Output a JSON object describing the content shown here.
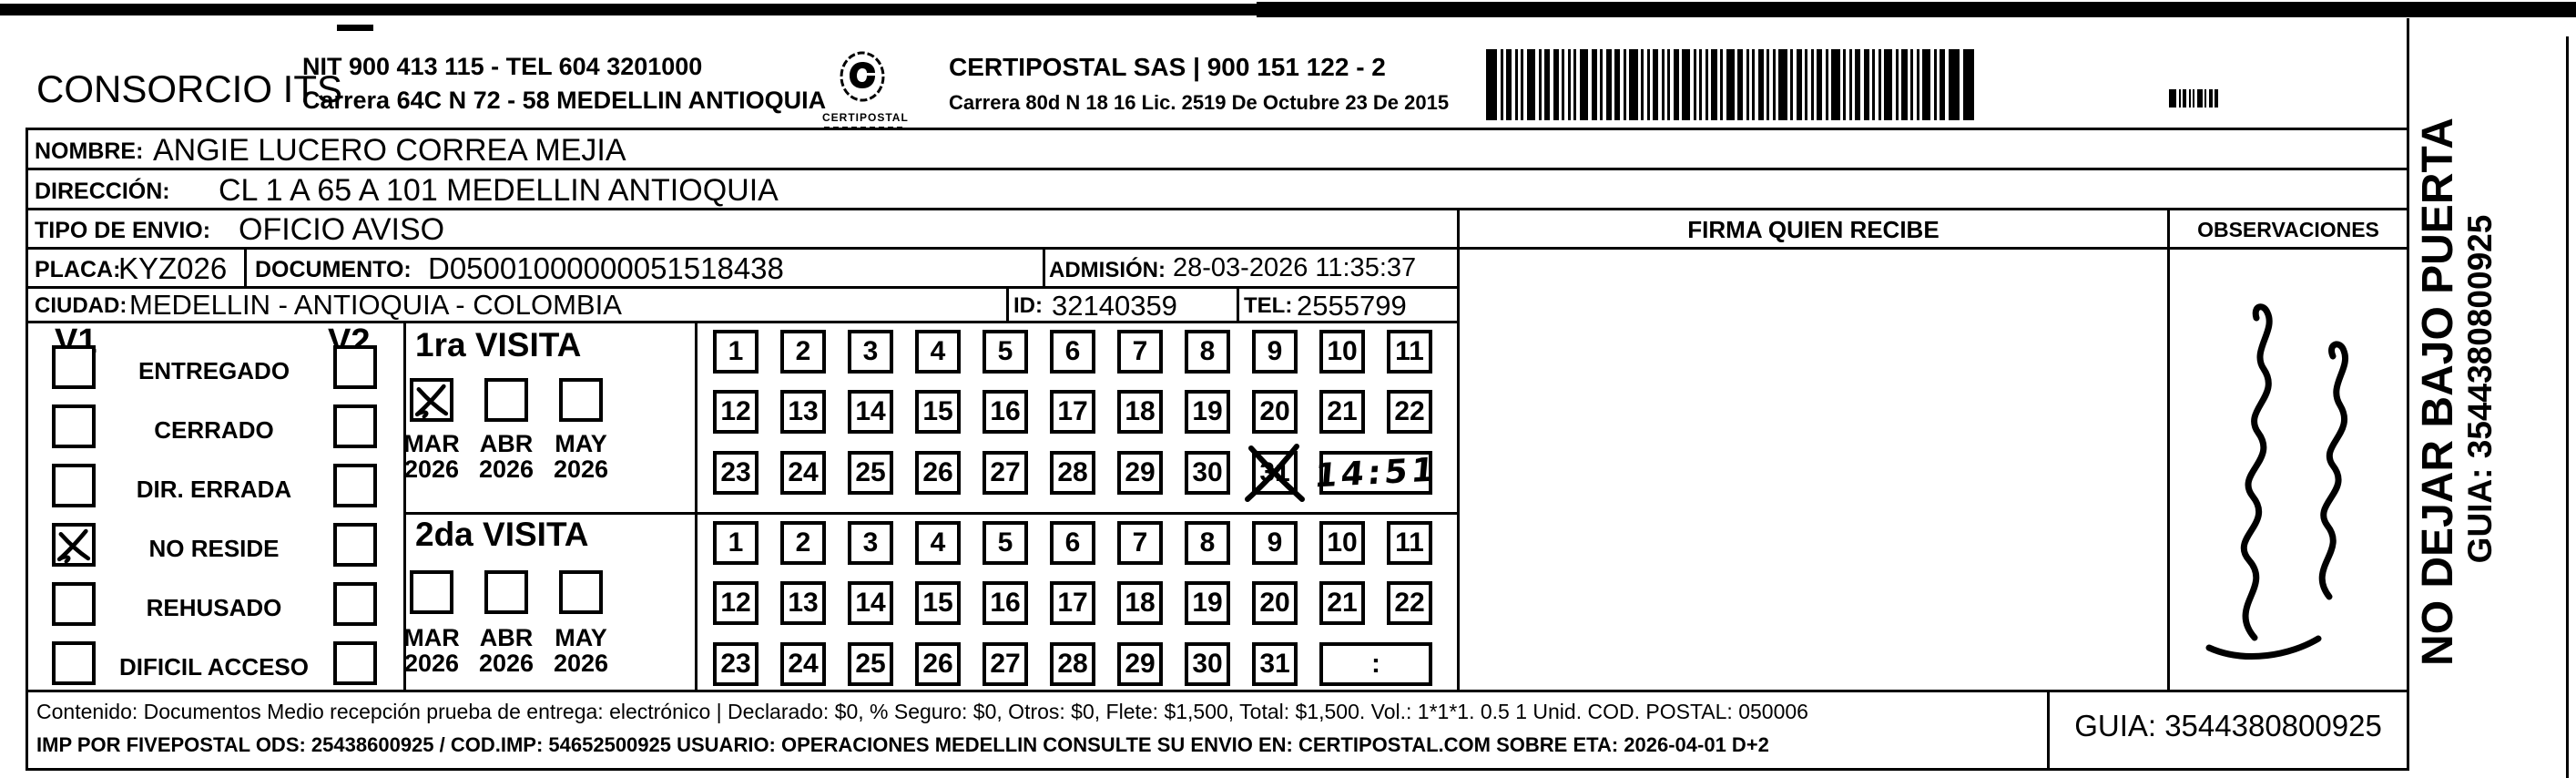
{
  "header": {
    "company": "CONSORCIO ITS",
    "nit_line": "NIT 900 413 115 - TEL 604 3201000",
    "address_line": "Carrera 64C N 72 - 58 MEDELLIN ANTIOQUIA",
    "logo_caption": "CERTIPOSTAL",
    "certipostal_line": "CERTIPOSTAL SAS | 900 151 122 - 2",
    "certipostal_address": "Carrera 80d N 18 16  Lic. 2519 De Octubre 23 De 2015"
  },
  "recipient": {
    "nombre_label": "NOMBRE:",
    "nombre": "ANGIE LUCERO CORREA MEJIA",
    "direccion_label": "DIRECCIÓN:",
    "direccion": "CL 1 A 65 A 101  MEDELLIN ANTIOQUIA",
    "tipo_envio_label": "TIPO DE ENVIO:",
    "tipo_envio": "OFICIO AVISO",
    "placa_label": "PLACA:",
    "placa": "KYZ026",
    "documento_label": "DOCUMENTO:",
    "documento": "D05001000000051518438",
    "admision_label": "ADMISIÓN:",
    "admision": "28-03-2026 11:35:37",
    "ciudad_label": "CIUDAD:",
    "ciudad": "MEDELLIN - ANTIOQUIA - COLOMBIA",
    "id_label": "ID:",
    "id": "32140359",
    "tel_label": "TEL:",
    "tel": "2555799"
  },
  "status": {
    "v1_label": "V1",
    "v2_label": "V2",
    "options": [
      "ENTREGADO",
      "CERRADO",
      "DIR. ERRADA",
      "NO RESIDE",
      "REHUSADO",
      "DIFICIL ACCESO"
    ],
    "v1_checked_index": 3
  },
  "visits": {
    "days": [
      1,
      2,
      3,
      4,
      5,
      6,
      7,
      8,
      9,
      10,
      11,
      12,
      13,
      14,
      15,
      16,
      17,
      18,
      19,
      20,
      21,
      22,
      23,
      24,
      25,
      26,
      27,
      28,
      29,
      30,
      31
    ],
    "first": {
      "title": "1ra VISITA",
      "months": [
        "MAR",
        "ABR",
        "MAY"
      ],
      "year": "2026",
      "checked_month_index": 0,
      "crossed_day": 31,
      "handwritten_time": "14:51"
    },
    "second": {
      "title": "2da VISITA",
      "months": [
        "MAR",
        "ABR",
        "MAY"
      ],
      "year": "2026",
      "checked_month_index": -1,
      "crossed_day": null,
      "time_placeholder": ":"
    }
  },
  "signature": {
    "firma_label": "FIRMA QUIEN RECIBE",
    "observaciones_label": "OBSERVACIONES"
  },
  "side": {
    "warning": "NO DEJAR BAJO PUERTA",
    "guia": "GUIA: 3544380800925"
  },
  "footer": {
    "line1": "Contenido: Documentos Medio recepción prueba de entrega: electrónico | Declarado: $0, % Seguro: $0, Otros: $0, Flete: $1,500, Total: $1,500. Vol.: 1*1*1. 0.5  1 Unid. COD. POSTAL: 050006",
    "line2": "IMP POR FIVEPOSTAL ODS: 25438600925 / COD.IMP: 54652500925 USUARIO: OPERACIONES MEDELLIN CONSULTE SU ENVIO EN: CERTIPOSTAL.COM SOBRE ETA: 2026-04-01 D+2",
    "guia_box": "GUIA: 3544380800925"
  }
}
